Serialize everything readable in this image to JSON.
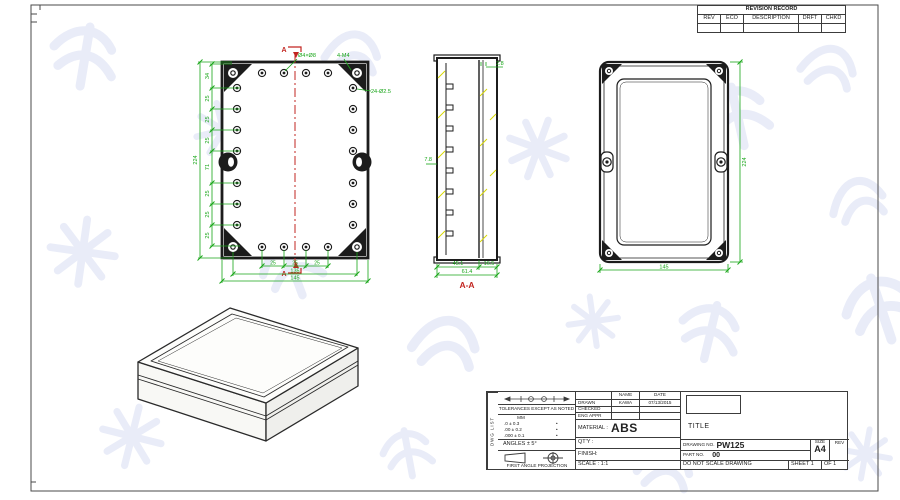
{
  "sheet": {
    "background": "#ffffff",
    "line_color": "#1c1c1c",
    "dim_color": "#17a517",
    "section_color": "#c22520",
    "hatch_color": "#d8d800",
    "watermark_color": "#e2e6f6"
  },
  "revision_table": {
    "title": "REVISION RECORD",
    "columns": [
      "REV",
      "ECO",
      "DESCRIPTION",
      "DRFT",
      "CHKD"
    ]
  },
  "views": {
    "front": {
      "section_letter_top": "A",
      "section_letter_bottom": "A",
      "leader_boss": "Ø4×Ø8",
      "leader_corner": "4-M4",
      "leader_holes": "24-Ø2.5",
      "dims_left": [
        "34",
        "25",
        "25",
        "25",
        "71",
        "25",
        "25",
        "25"
      ],
      "dim_left_overall": "224",
      "dims_bottom": [
        "25",
        "25",
        "25"
      ],
      "dim_bottom_inner": "135",
      "dim_bottom_overall": "145"
    },
    "section": {
      "label": "A-A",
      "dim_top_right": "2.8",
      "dim_left": "7.8",
      "dim_bottom_left": "45.1",
      "dim_bottom_right": "16.5",
      "dim_bottom_overall": "61.4"
    },
    "lid": {
      "dim_right": "224",
      "dim_bottom": "145"
    }
  },
  "title_block": {
    "side_label": "DWG LIST",
    "tolerances_heading": "TOLERANCES EXCEPT AS NOTED",
    "unit_header": "MM",
    "tolerance_rows": [
      ".0 ± 0.3",
      ".00 ± 0.2",
      ".000 ± 0.1"
    ],
    "tolerance_dot": "•",
    "angles": "ANGLES ± 5°",
    "projection_label": "FIRST ANGLE PROJECTION",
    "name_header": "NAME",
    "date_header": "DATE",
    "drawn_label": "DRAWN",
    "drawn_name": "KAWA",
    "drawn_date": "07/13/2015",
    "checked_label": "CHECKED",
    "eng_appr_label": "ENG APPR",
    "material_label": "MATERIAL :",
    "material_value": "ABS",
    "qty_label": "QT'Y :",
    "finish_label": "FINISH:",
    "scale_label": "SCALE : 1:1",
    "title_label": "TITLE",
    "drawing_no_label": "DRAWING NO.",
    "drawing_no": "PW125",
    "part_no_label": "PART NO.",
    "part_no": "00",
    "size_label": "SIZE",
    "size_value": "A4",
    "rev_label": "REV",
    "do_not_scale": "DO NOT SCALE DRAWING",
    "sheet_label": "SHEET 1",
    "of_label": "OF 1"
  }
}
